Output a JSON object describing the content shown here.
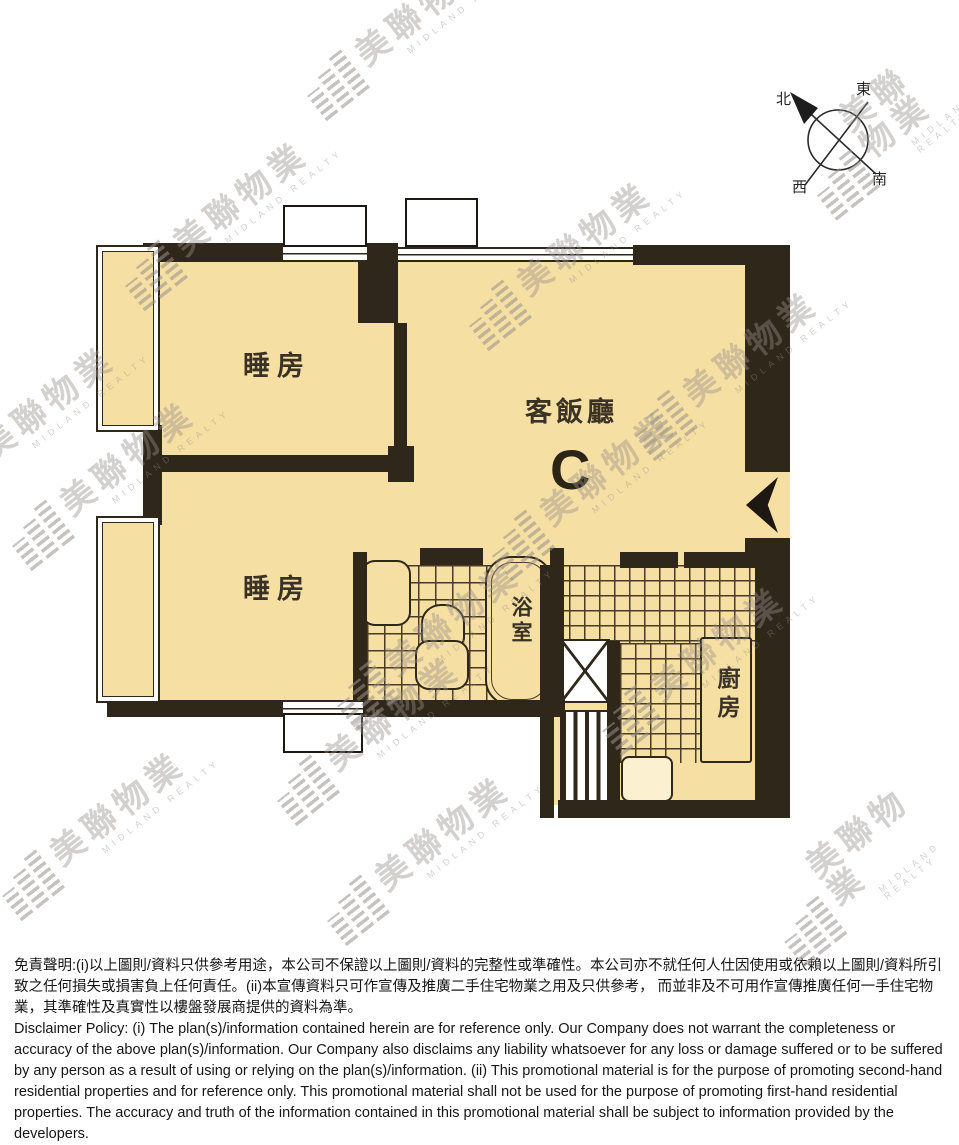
{
  "compass": {
    "north": "北",
    "east": "東",
    "south": "南",
    "west": "西"
  },
  "floor_plan": {
    "bedroom1_label": "睡房",
    "bedroom2_label": "睡房",
    "living_dining_label": "客飯廳",
    "unit_label": "C",
    "bathroom_label": "浴室",
    "kitchen_label": "廚房"
  },
  "watermark": {
    "cjk": "美聯物業",
    "en": "MIDLAND REALTY"
  },
  "disclaimer": {
    "chinese": "免責聲明:(i)以上圖則/資料只供參考用途，本公司不保證以上圖則/資料的完整性或準確性。本公司亦不就任何人仕因使用或依賴以上圖則/資料所引致之任何損失或損害負上任何責任。(ii)本宣傳資料只可作宣傳及推廣二手住宅物業之用及只供參考， 而並非及不可用作宣傳推廣任何一手住宅物業，其準確性及真實性以樓盤發展商提供的資料為準。",
    "english": "Disclaimer Policy: (i) The plan(s)/information contained herein are for reference only. Our Company does not warrant the completeness or accuracy of the above plan(s)/information. Our Company also disclaims any liability whatsoever for any loss or damage suffered or to be suffered by any person as a result of using or relying on the plan(s)/information. (ii) This promotional material is for the purpose of promoting second-hand residential properties and for reference only. This promotional material shall not be used for the purpose of promoting first-hand residential properties. The accuracy and truth of the information contained in this promotional material shall be subject to information provided by the developers."
  },
  "colors": {
    "floor": "#f6dfa3",
    "wall": "#2f2719",
    "tile_line": "#4a3b24",
    "watermark": "#b9b2ac"
  }
}
